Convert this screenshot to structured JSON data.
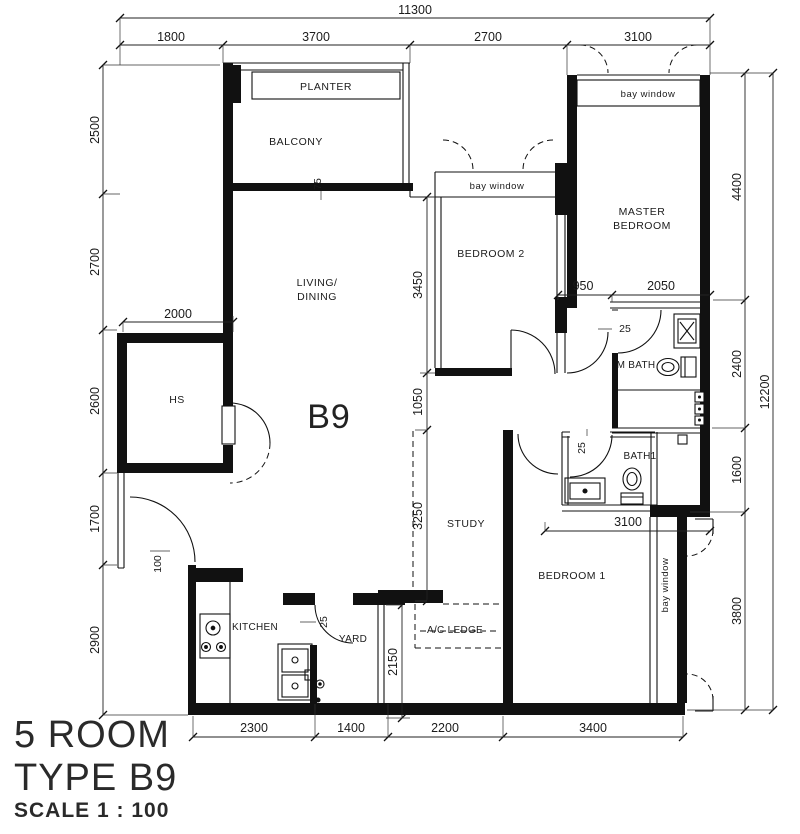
{
  "document": {
    "type_label": "5 ROOM",
    "type_code": "TYPE B9",
    "scale": "SCALE 1 : 100",
    "plan_code": "B9"
  },
  "rooms": {
    "planter": "PLANTER",
    "balcony": "BALCONY",
    "living": "LIVING/",
    "dining": "DINING",
    "bedroom2": "BEDROOM 2",
    "master1": "MASTER",
    "master2": "BEDROOM",
    "hs": "HS",
    "mbath": "M BATH",
    "bath1": "BATH1",
    "study": "STUDY",
    "bedroom1": "BEDROOM 1",
    "kitchen": "KITCHEN",
    "yard": "YARD",
    "ac_ledge": "A/C LEDGE",
    "bay_window": "bay window"
  },
  "dims": {
    "overall_width": "11300",
    "top": [
      "1800",
      "3700",
      "2700",
      "3100"
    ],
    "left": [
      "2500",
      "2700",
      "2600",
      "1700",
      "2900"
    ],
    "right": [
      "4400",
      "2400",
      "1600",
      "3800"
    ],
    "right_total": "12200",
    "bottom": [
      "2300",
      "1400",
      "2200",
      "3400"
    ],
    "inner": {
      "w2000": "2000",
      "h3450": "3450",
      "h1050": "1050",
      "h3250": "3250",
      "h2150": "2150",
      "w950": "950",
      "w2050": "2050",
      "w3100": "3100",
      "t100": "100",
      "t75": "75",
      "t25": "25"
    }
  }
}
